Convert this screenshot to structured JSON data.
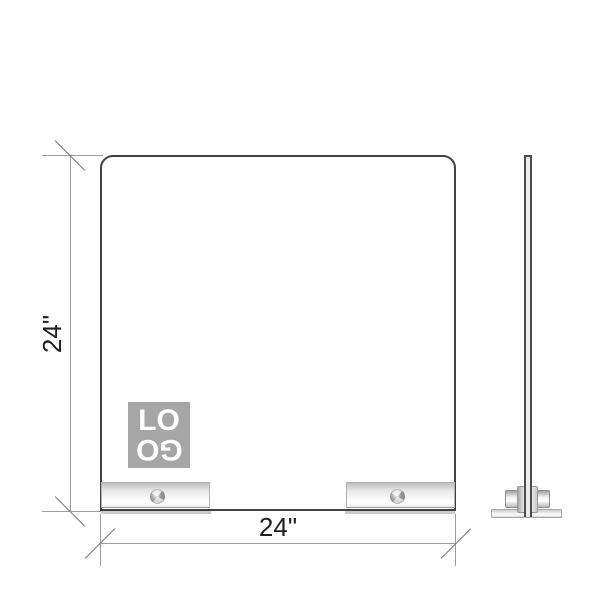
{
  "drawing": {
    "front_view": {
      "height_label": "24\"",
      "width_label": "24\"",
      "logo": {
        "line1": "LO",
        "line2": "GO"
      }
    },
    "colors": {
      "background": "#ffffff",
      "panel_border": "#414141",
      "dimension_line": "#9c9c9c",
      "tick_mark": "#7a7a7a",
      "dimension_text": "#1e1e1e",
      "logo_background": "#a6a6a6",
      "logo_text": "#ffffff",
      "foot_metal_light": "#ffffff",
      "foot_metal_dark": "#bdbdbd"
    }
  }
}
